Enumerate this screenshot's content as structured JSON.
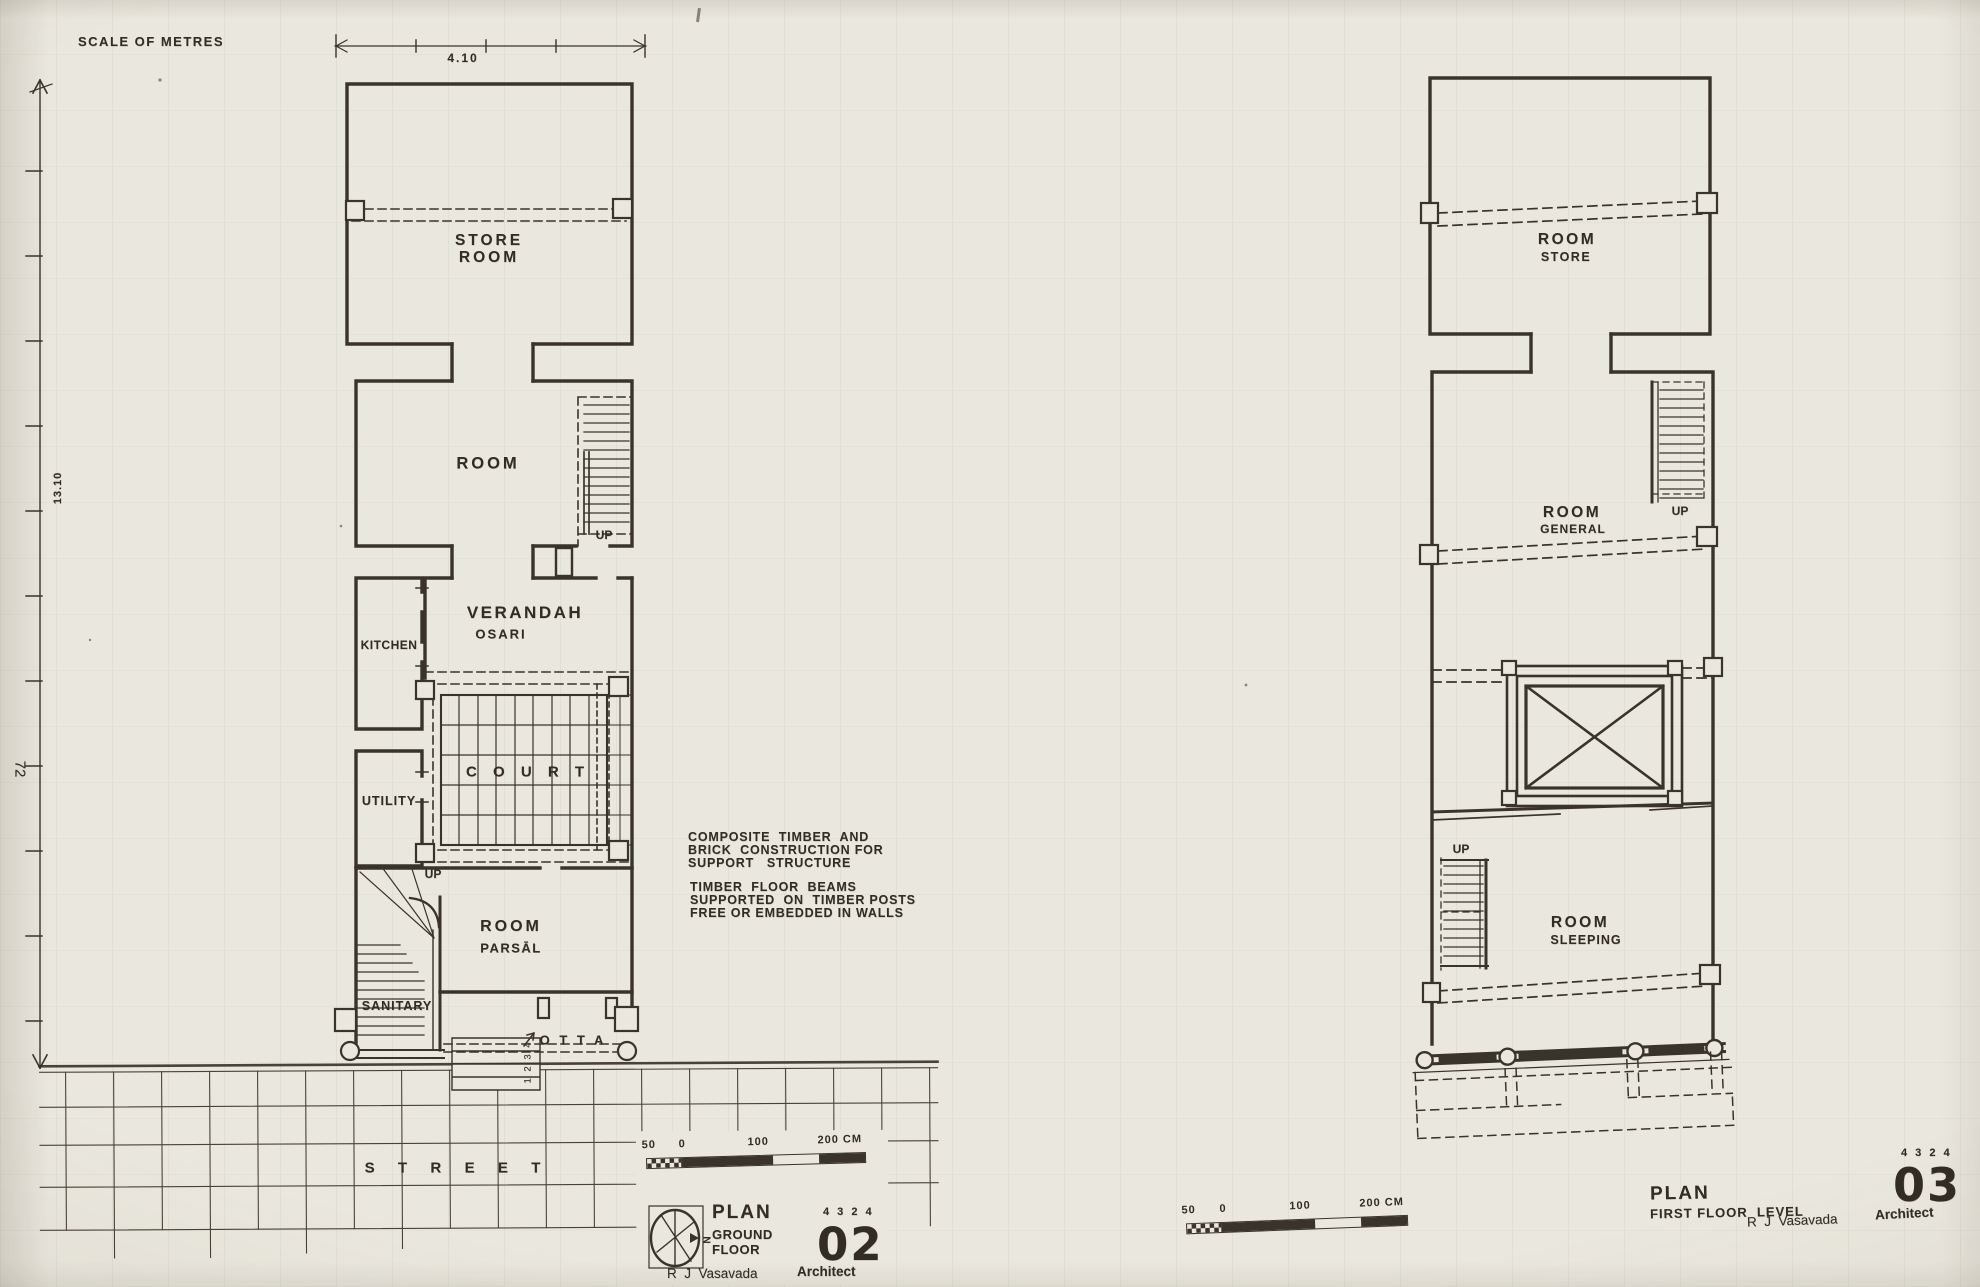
{
  "page": {
    "number": "72",
    "scale_heading": "SCALE OF METRES",
    "top_dim": "4.10",
    "left_dim": "13.10"
  },
  "notes": {
    "l1": "COMPOSITE  TIMBER  AND",
    "l2": "BRICK  CONSTRUCTION FOR",
    "l3": "SUPPORT   STRUCTURE",
    "l4": "TIMBER  FLOOR  BEAMS",
    "l5": "SUPPORTED  ON  TIMBER POSTS",
    "l6": "FREE OR EMBEDDED IN WALLS"
  },
  "ground_floor": {
    "store_l1": "STORE",
    "store_l2": "ROOM",
    "room": "ROOM",
    "up_stair": "UP",
    "verandah": "VERANDAH",
    "osari": "OSARI",
    "kitchen": "KITCHEN",
    "utility": "UTILITY",
    "court": "C O U R T",
    "up_parsal": "UP",
    "parsal_l1": "ROOM",
    "parsal_l2": "PARSĀL",
    "sanitary": "SANITARY",
    "otta": "O T T A",
    "otta_steps": "1 2 3 4",
    "street": "S  T  R  E  E  T",
    "scalebar": {
      "m50": "50",
      "m0": "0",
      "m100": "100",
      "m200": "200 CM"
    },
    "title": {
      "north": "N",
      "plan": "PLAN",
      "floor_l1": "GROUND",
      "floor_l2": "FLOOR",
      "job": "4 3 2 4",
      "sheet": "02",
      "author": "R  J  Vasavada",
      "role": "Architect"
    }
  },
  "first_floor": {
    "store_l1": "ROOM",
    "store_l2": "STORE",
    "general_l1": "ROOM",
    "general_l2": "GENERAL",
    "up_top": "UP",
    "up_bottom": "UP",
    "sleeping_l1": "ROOM",
    "sleeping_l2": "SLEEPING",
    "scalebar": {
      "m50": "50",
      "m0": "0",
      "m100": "100",
      "m200": "200 CM"
    },
    "title": {
      "plan": "PLAN",
      "floor": "FIRST FLOOR  LEVEL",
      "job": "4 3 2 4",
      "sheet": "03",
      "author": "R  J  Vasavada",
      "role": "Architect"
    }
  }
}
